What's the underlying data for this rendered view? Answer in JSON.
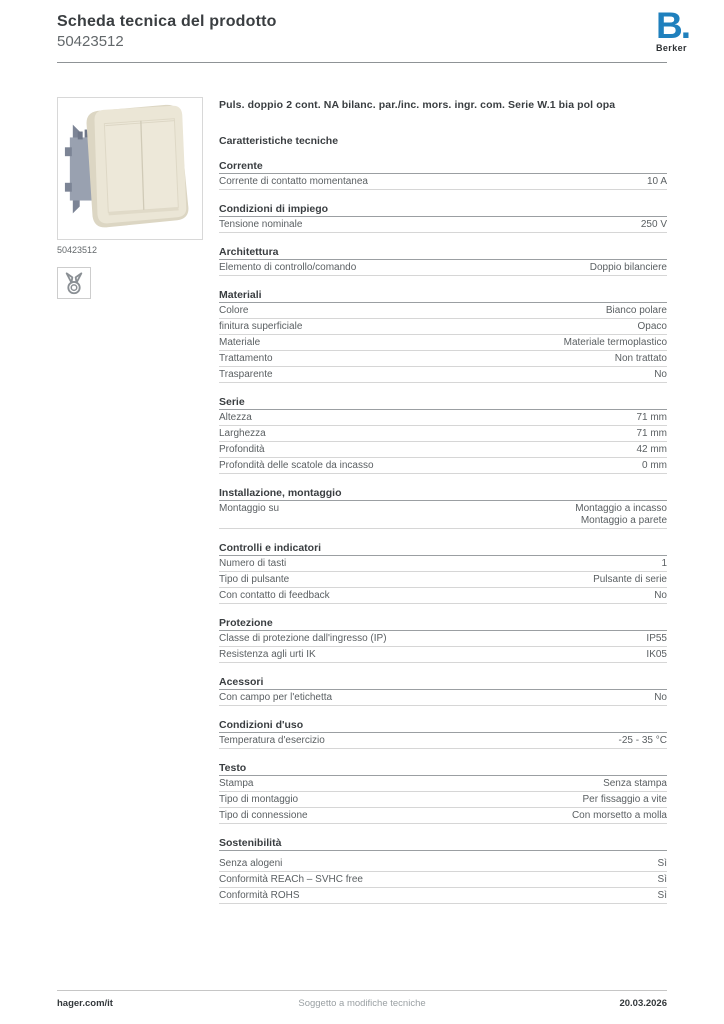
{
  "header": {
    "title": "Scheda tecnica del prodotto",
    "product_number": "50423512",
    "logo": {
      "letter": "B.",
      "brand": "Berker",
      "color": "#1f80bd"
    }
  },
  "product": {
    "image_caption": "50423512",
    "image_icon": "claw-fixing-icon",
    "description": "Puls. doppio 2 cont. NA bilanc. par./inc. mors. ingr. com. Serie W.1 bia pol opa"
  },
  "specs": {
    "heading": "Caratteristiche tecniche",
    "sections": [
      {
        "title": "Corrente",
        "rows": [
          {
            "label": "Corrente di contatto momentanea",
            "value": "10 A"
          }
        ]
      },
      {
        "title": "Condizioni di impiego",
        "rows": [
          {
            "label": "Tensione nominale",
            "value": "250 V"
          }
        ]
      },
      {
        "title": "Architettura",
        "rows": [
          {
            "label": "Elemento di controllo/comando",
            "value": "Doppio bilanciere"
          }
        ]
      },
      {
        "title": "Materiali",
        "rows": [
          {
            "label": "Colore",
            "value": "Bianco polare"
          },
          {
            "label": "finitura superficiale",
            "value": "Opaco"
          },
          {
            "label": "Materiale",
            "value": "Materiale termoplastico"
          },
          {
            "label": "Trattamento",
            "value": "Non trattato"
          },
          {
            "label": "Trasparente",
            "value": "No"
          }
        ]
      },
      {
        "title": "Serie",
        "rows": [
          {
            "label": "Altezza",
            "value": "71 mm"
          },
          {
            "label": "Larghezza",
            "value": "71 mm"
          },
          {
            "label": "Profondità",
            "value": "42 mm"
          },
          {
            "label": "Profondità delle scatole da incasso",
            "value": "0 mm"
          }
        ]
      },
      {
        "title": "Installazione, montaggio",
        "rows": [
          {
            "label": "Montaggio su",
            "value": "Montaggio a incasso\nMontaggio a parete"
          }
        ]
      },
      {
        "title": "Controlli e indicatori",
        "rows": [
          {
            "label": "Numero di tasti",
            "value": "1"
          },
          {
            "label": "Tipo di pulsante",
            "value": "Pulsante di serie"
          },
          {
            "label": "Con contatto di feedback",
            "value": "No"
          }
        ]
      },
      {
        "title": "Protezione",
        "rows": [
          {
            "label": "Classe di protezione dall'ingresso (IP)",
            "value": "IP55"
          },
          {
            "label": "Resistenza agli urti IK",
            "value": "IK05"
          }
        ]
      },
      {
        "title": "Acessori",
        "rows": [
          {
            "label": "Con campo per l'etichetta",
            "value": "No"
          }
        ]
      },
      {
        "title": "Condizioni d'uso",
        "rows": [
          {
            "label": "Temperatura d'esercizio",
            "value": "-25 - 35 °C"
          }
        ]
      },
      {
        "title": "Testo",
        "rows": [
          {
            "label": "Stampa",
            "value": "Senza stampa"
          },
          {
            "label": "Tipo di montaggio",
            "value": "Per fissaggio a vite"
          },
          {
            "label": "Tipo di connessione",
            "value": "Con morsetto a molla"
          }
        ]
      },
      {
        "title": "Sostenibilità",
        "rows": [
          {
            "label": "Senza alogeni",
            "value": "Sì"
          },
          {
            "label": "Conformità REACh – SVHC free",
            "value": "Sì"
          },
          {
            "label": "Conformità ROHS",
            "value": "Sì"
          }
        ]
      }
    ]
  },
  "footer": {
    "left": "hager.com/it",
    "center": "Soggetto a modifiche tecniche",
    "right": "20.03.2026"
  },
  "colors": {
    "brand_blue": "#1f80bd",
    "text_dark": "#3a3e41",
    "text_gray": "#5a5f62",
    "rule_dark": "#9b9fa2",
    "rule_light": "#d6d6d6"
  }
}
